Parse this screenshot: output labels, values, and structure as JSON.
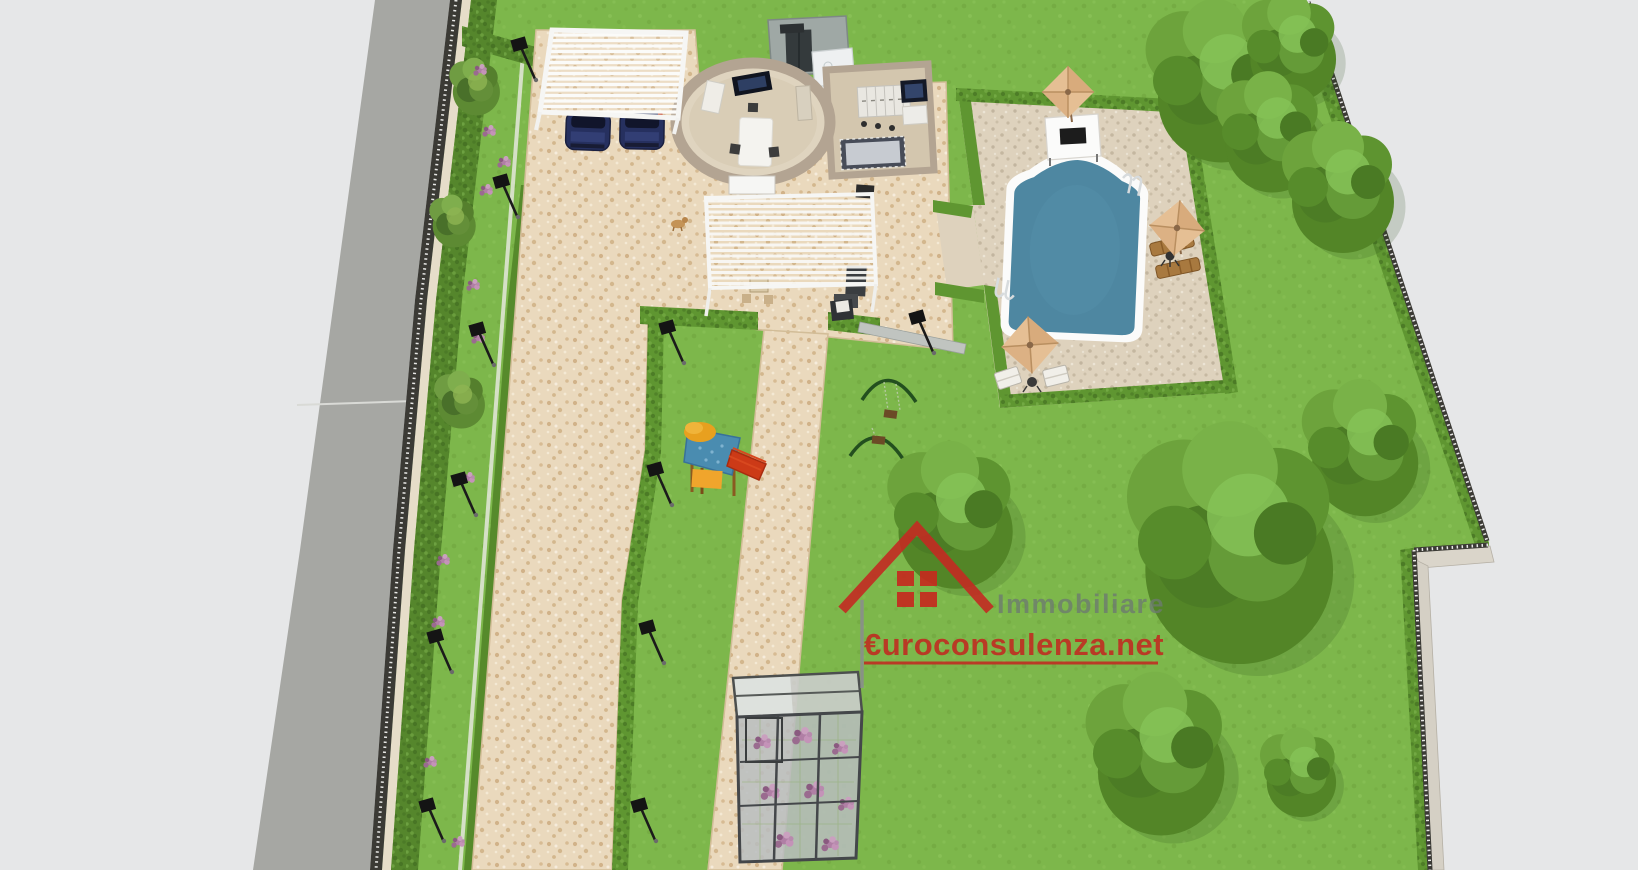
{
  "watermark": {
    "logo": "house-roof-icon",
    "line1": "Immobiliare",
    "line2": "€uroconsulenza.net",
    "line1_color": "#6d7a70",
    "line2_color": "#c32620"
  },
  "palette": {
    "background": "#e6e7e8",
    "road": "#a6a7a3",
    "road_marking": "#d9dad6",
    "lawn": "#7db74b",
    "hedge_dark": "#55862c",
    "hedge_bright": "#5f9631",
    "paving": "#ead9bd",
    "pool_patio": "#ded2bd",
    "pool_water": "#4e87a1",
    "umbrella": "#e5bf94",
    "house_wall": "#b3a492",
    "pergola": "#f6f6f4",
    "car": "#26305f",
    "fence": "#3b3a35"
  }
}
